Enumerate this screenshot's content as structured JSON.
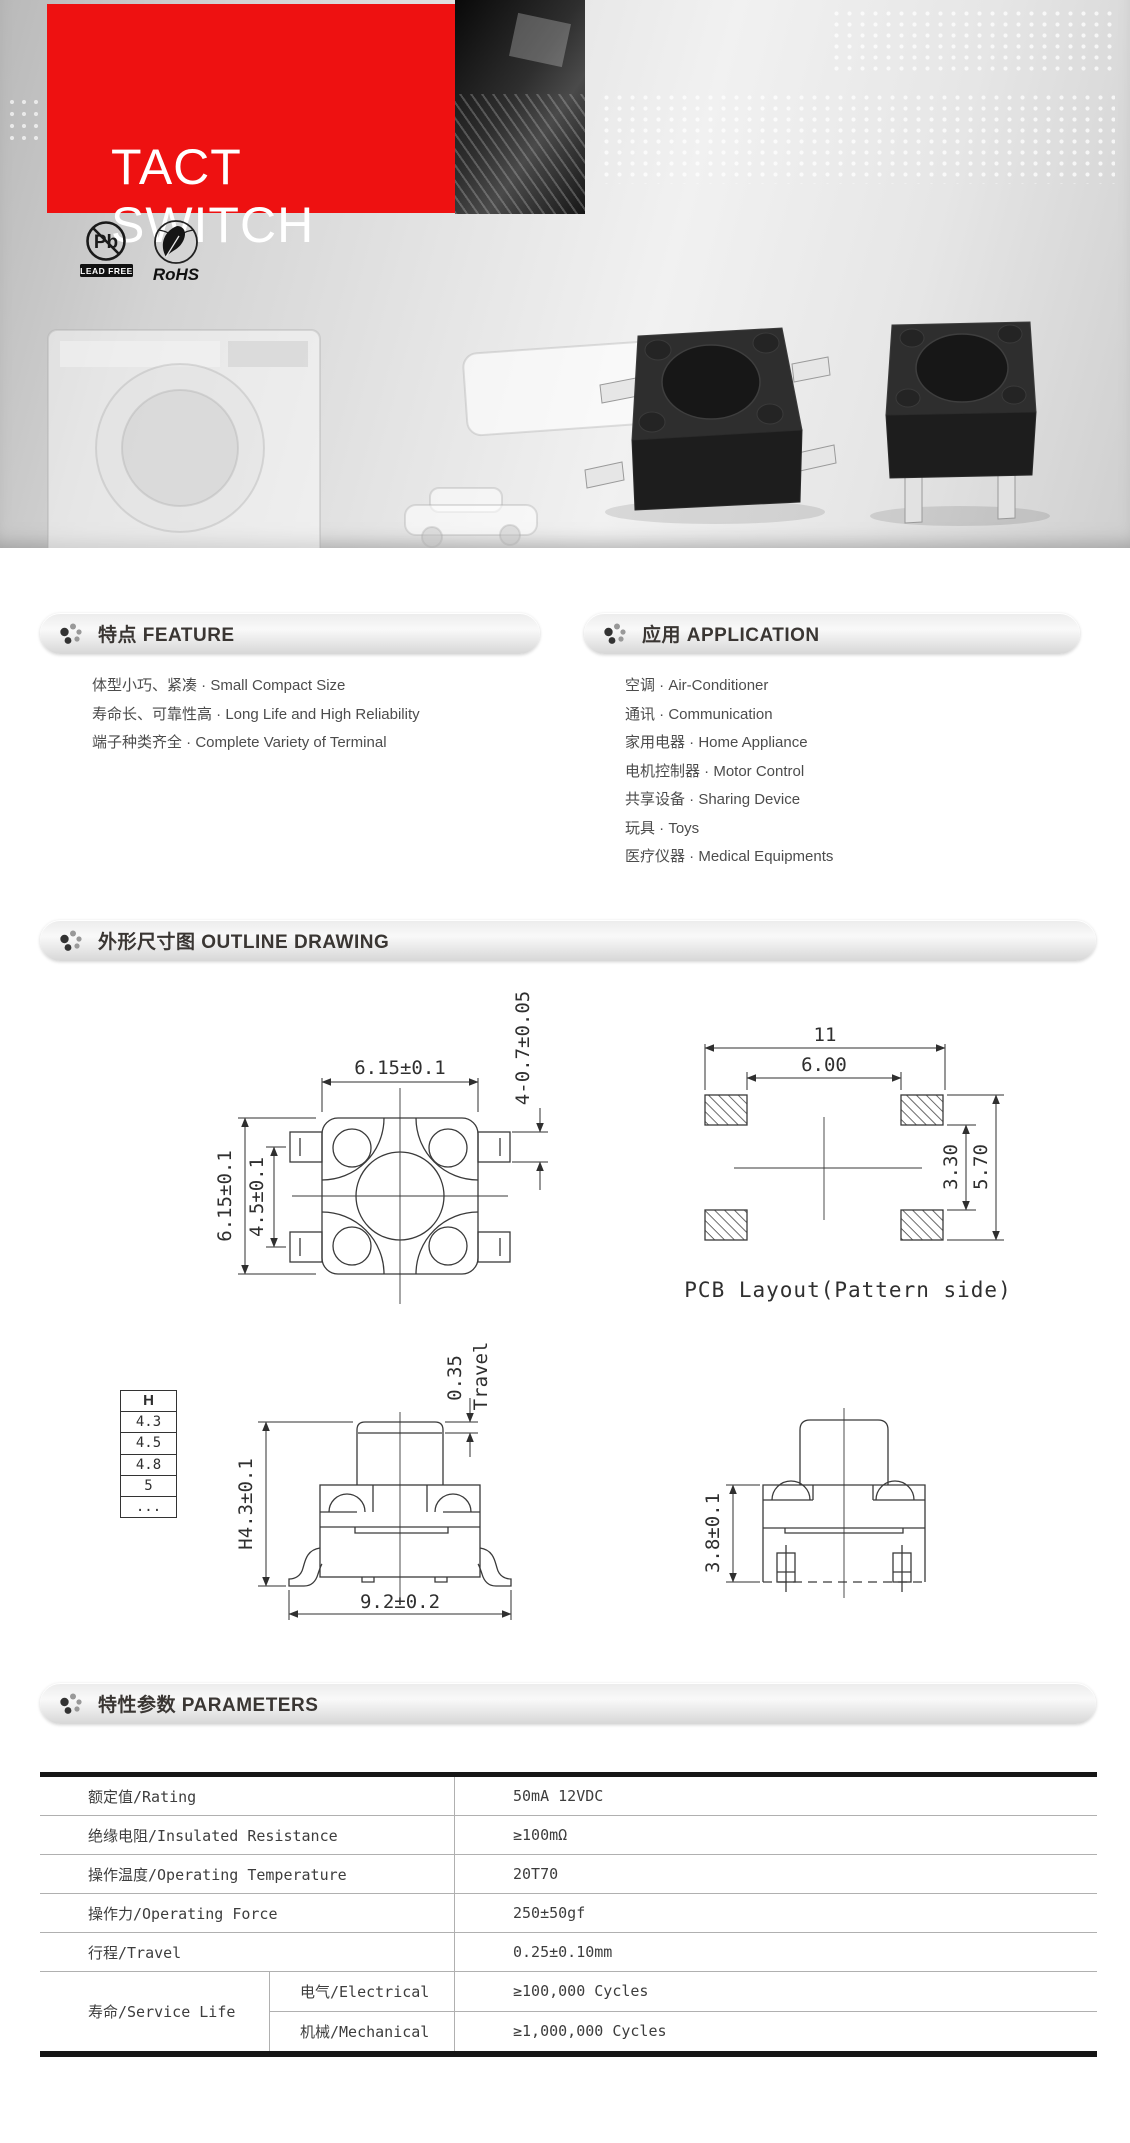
{
  "hero": {
    "title": "TACT SWITCH",
    "badges": {
      "pb_symbol": "Pb",
      "pb_label": "LEAD FREE",
      "rohs_label": "RoHS"
    }
  },
  "feature": {
    "title": "特点 FEATURE",
    "items": [
      "体型小巧、紧凑 · Small Compact Size",
      "寿命长、可靠性高 · Long Life and High Reliability",
      "端子种类齐全 · Complete Variety of Terminal"
    ]
  },
  "application": {
    "title": "应用 APPLICATION",
    "items": [
      "空调 · Air-Conditioner",
      "通讯 · Communication",
      "家用电器 · Home Appliance",
      "电机控制器 · Motor Control",
      "共享设备 · Sharing Device",
      "玩具 · Toys",
      "医疗仪器 · Medical Equipments"
    ]
  },
  "outline": {
    "title": "外形尺寸图 OUTLINE DRAWING",
    "top_view": {
      "dim_width": "6.15±0.1",
      "dim_height": "6.15±0.1",
      "dim_pin_span": "4.5±0.1",
      "dim_pin": "4-0.7±0.05"
    },
    "pcb": {
      "dim_outer_w": "11",
      "dim_inner_w": "6.00",
      "dim_inner_h": "3.30",
      "dim_outer_h": "5.70",
      "caption": "PCB Layout(Pattern side)"
    },
    "h_table": {
      "header": "H",
      "rows": [
        "4.3",
        "4.5",
        "4.8",
        "5",
        "..."
      ]
    },
    "front_view": {
      "travel_value": "0.35",
      "travel_label": "Travel",
      "dim_height": "H4.3±0.1",
      "dim_width": "9.2±0.2"
    },
    "side_view": {
      "dim_height": "3.8±0.1"
    }
  },
  "parameters": {
    "title": "特性参数 PARAMETERS",
    "rows": [
      {
        "label": "额定值/Rating",
        "value": "50mA 12VDC"
      },
      {
        "label": "绝缘电阻/Insulated Resistance",
        "value": "≥100mΩ"
      },
      {
        "label": "操作温度/Operating Temperature",
        "value": "20T70"
      },
      {
        "label": "操作力/Operating Force",
        "value": "250±50gf"
      },
      {
        "label": "行程/Travel",
        "value": "0.25±0.10mm"
      }
    ],
    "service_life": {
      "label": "寿命/Service Life",
      "sub": [
        {
          "label": "电气/Electrical",
          "value": "≥100,000 Cycles"
        },
        {
          "label": "机械/Mechanical",
          "value": "≥1,000,000 Cycles"
        }
      ]
    }
  }
}
